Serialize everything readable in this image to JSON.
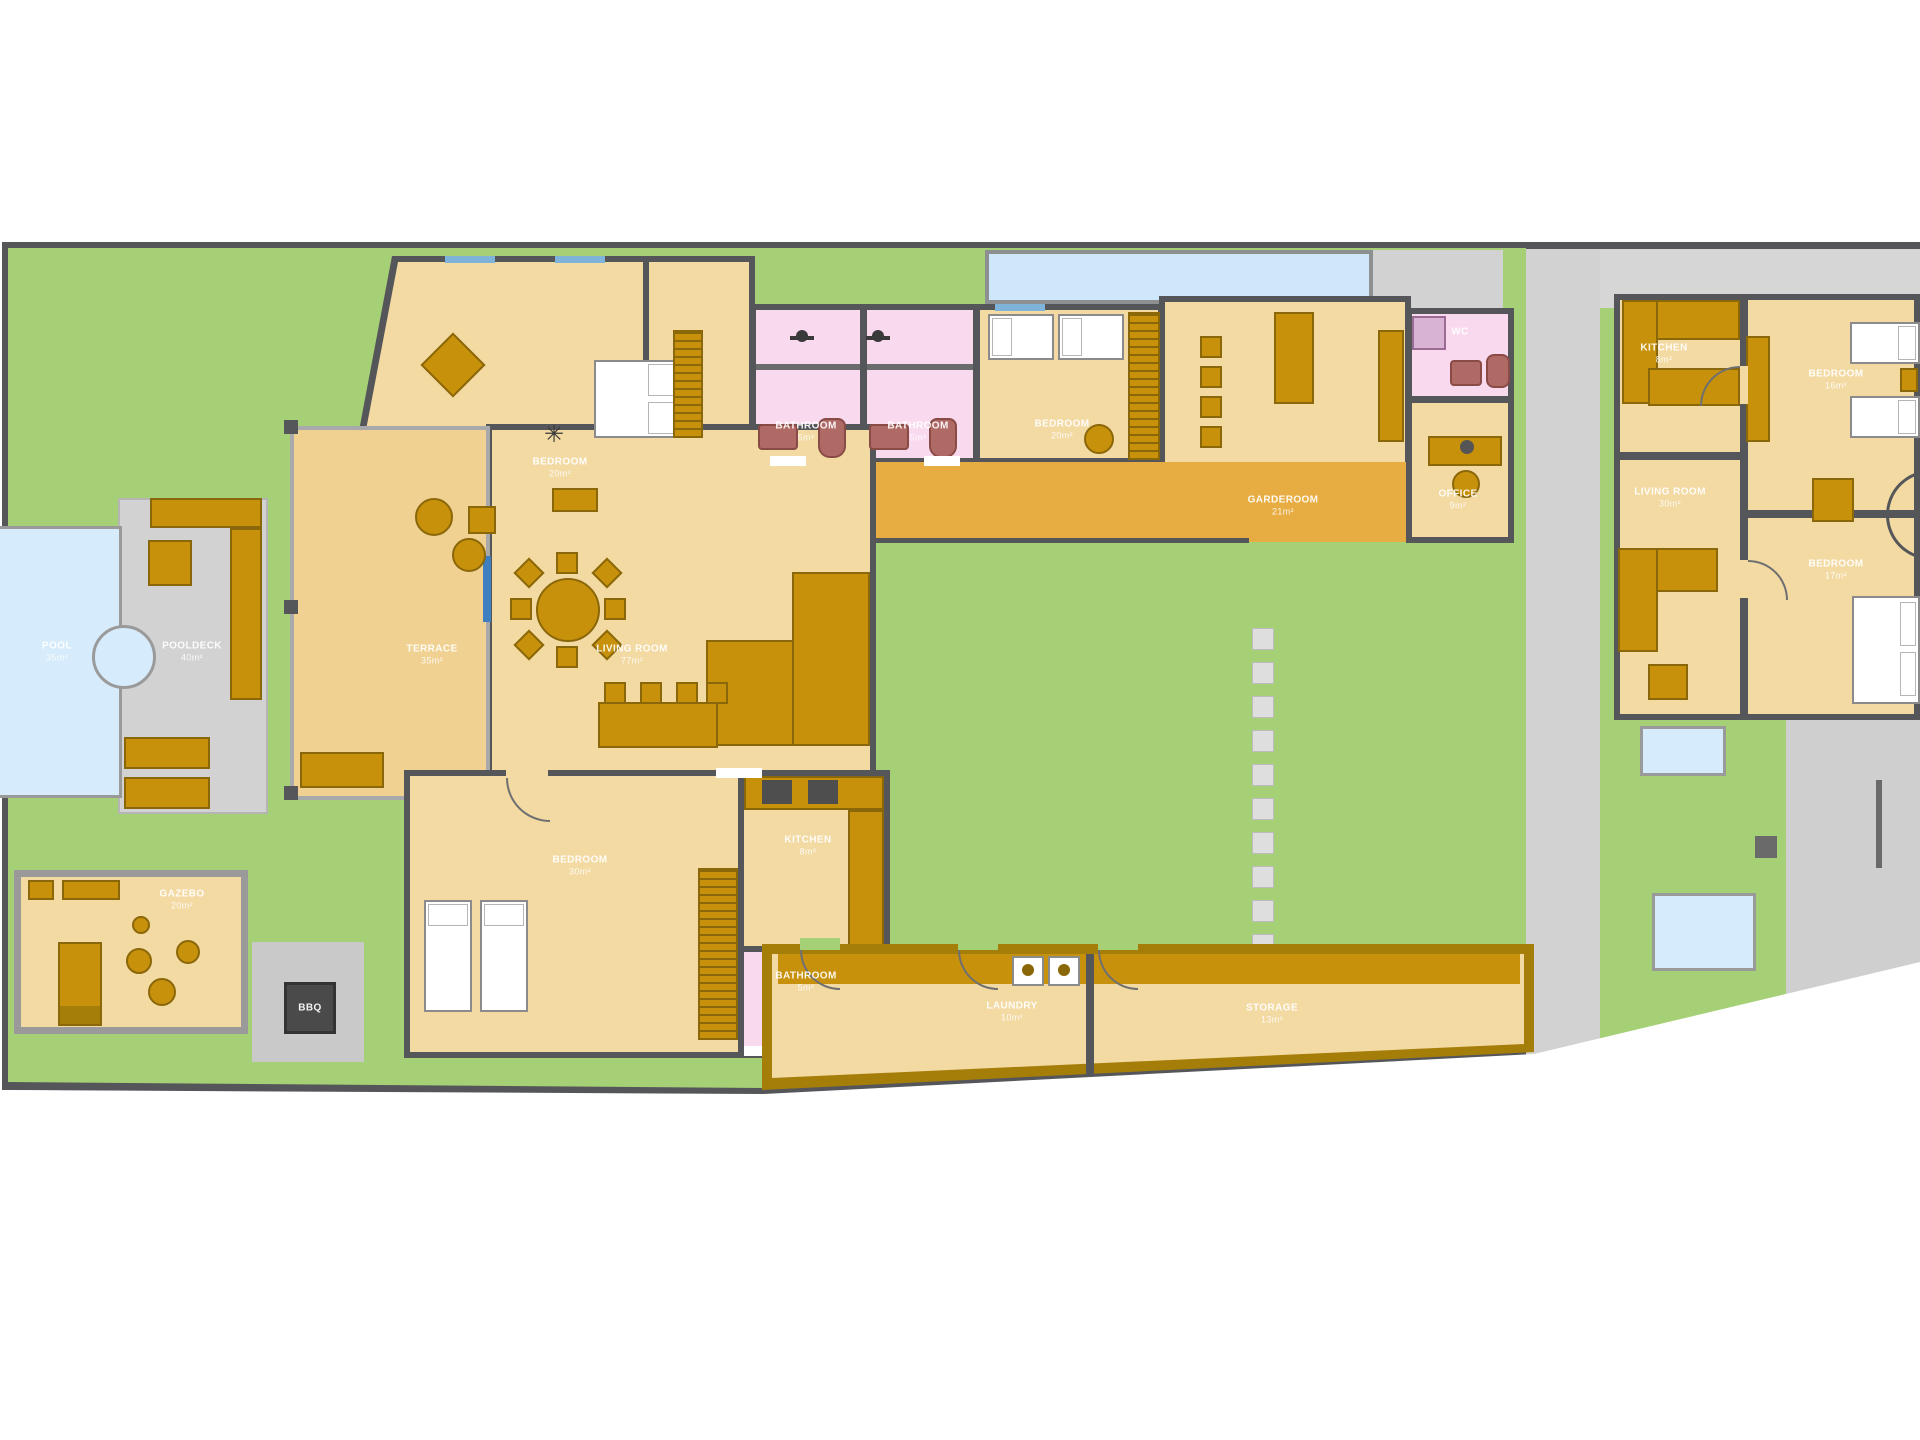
{
  "title": "Villa property floor plan",
  "colors": {
    "lawn": "#a6d075",
    "wall": "#55565a",
    "room_tan": "#f3d9a2",
    "terrace_tan": "#f0d191",
    "deck_orange": "#e8ad42",
    "bathroom_pink": "#f9d9ee",
    "pool_blue": "#d6ebfb",
    "paving_gray": "#d2d2d2",
    "furniture": "#c8910b",
    "furniture_dark": "#8a6708",
    "fixture_maroon": "#b06a66",
    "label_text": "#ffffff",
    "bbq_pad": "#c9c9c9",
    "bbq_unit": "#4a4a4a",
    "strip_building_wall": "#a57e0a"
  },
  "rooms": [
    {
      "id": "pool",
      "label": "POOL",
      "area": "35m²",
      "x": 57,
      "y": 652
    },
    {
      "id": "pooldeck",
      "label": "POOLDECK",
      "area": "40m²",
      "x": 192,
      "y": 652
    },
    {
      "id": "terrace",
      "label": "TERRACE",
      "area": "35m²",
      "x": 432,
      "y": 655
    },
    {
      "id": "living-room",
      "label": "LIVING ROOM",
      "area": "77m²",
      "x": 632,
      "y": 655
    },
    {
      "id": "bedroom-top-left",
      "label": "BEDROOM",
      "area": "20m²",
      "x": 560,
      "y": 468
    },
    {
      "id": "bathroom-1",
      "label": "BATHROOM",
      "area": "5m²",
      "x": 806,
      "y": 432
    },
    {
      "id": "bathroom-2",
      "label": "BATHROOM",
      "area": "5m²",
      "x": 918,
      "y": 432
    },
    {
      "id": "bedroom-top-center",
      "label": "BEDROOM",
      "area": "20m²",
      "x": 1062,
      "y": 430
    },
    {
      "id": "garderoom",
      "label": "GARDEROOM",
      "area": "21m²",
      "x": 1283,
      "y": 506
    },
    {
      "id": "wc",
      "label": "WC",
      "area": "",
      "x": 1460,
      "y": 332
    },
    {
      "id": "office",
      "label": "OFFICE",
      "area": "9m²",
      "x": 1458,
      "y": 500
    },
    {
      "id": "bedroom-bottom",
      "label": "BEDROOM",
      "area": "30m²",
      "x": 580,
      "y": 866
    },
    {
      "id": "kitchen-main",
      "label": "KITCHEN",
      "area": "8m²",
      "x": 808,
      "y": 846
    },
    {
      "id": "bathroom-3",
      "label": "BATHROOM",
      "area": "5m²",
      "x": 806,
      "y": 982
    },
    {
      "id": "laundry",
      "label": "LAUNDRY",
      "area": "10m²",
      "x": 1012,
      "y": 1012
    },
    {
      "id": "storage",
      "label": "STORAGE",
      "area": "13m²",
      "x": 1272,
      "y": 1014
    },
    {
      "id": "gazebo",
      "label": "GAZEBO",
      "area": "20m²",
      "x": 182,
      "y": 900
    },
    {
      "id": "bbq",
      "label": "BBQ",
      "area": "",
      "x": 310,
      "y": 1008
    },
    {
      "id": "kitchen-guest",
      "label": "KITCHEN",
      "area": "8m²",
      "x": 1664,
      "y": 354
    },
    {
      "id": "bedroom-guest-1",
      "label": "BEDROOM",
      "area": "16m²",
      "x": 1836,
      "y": 380
    },
    {
      "id": "living-room-guest",
      "label": "LIVING ROOM",
      "area": "30m²",
      "x": 1670,
      "y": 498
    },
    {
      "id": "bedroom-guest-2",
      "label": "BEDROOM",
      "area": "17m²",
      "x": 1836,
      "y": 570
    }
  ]
}
